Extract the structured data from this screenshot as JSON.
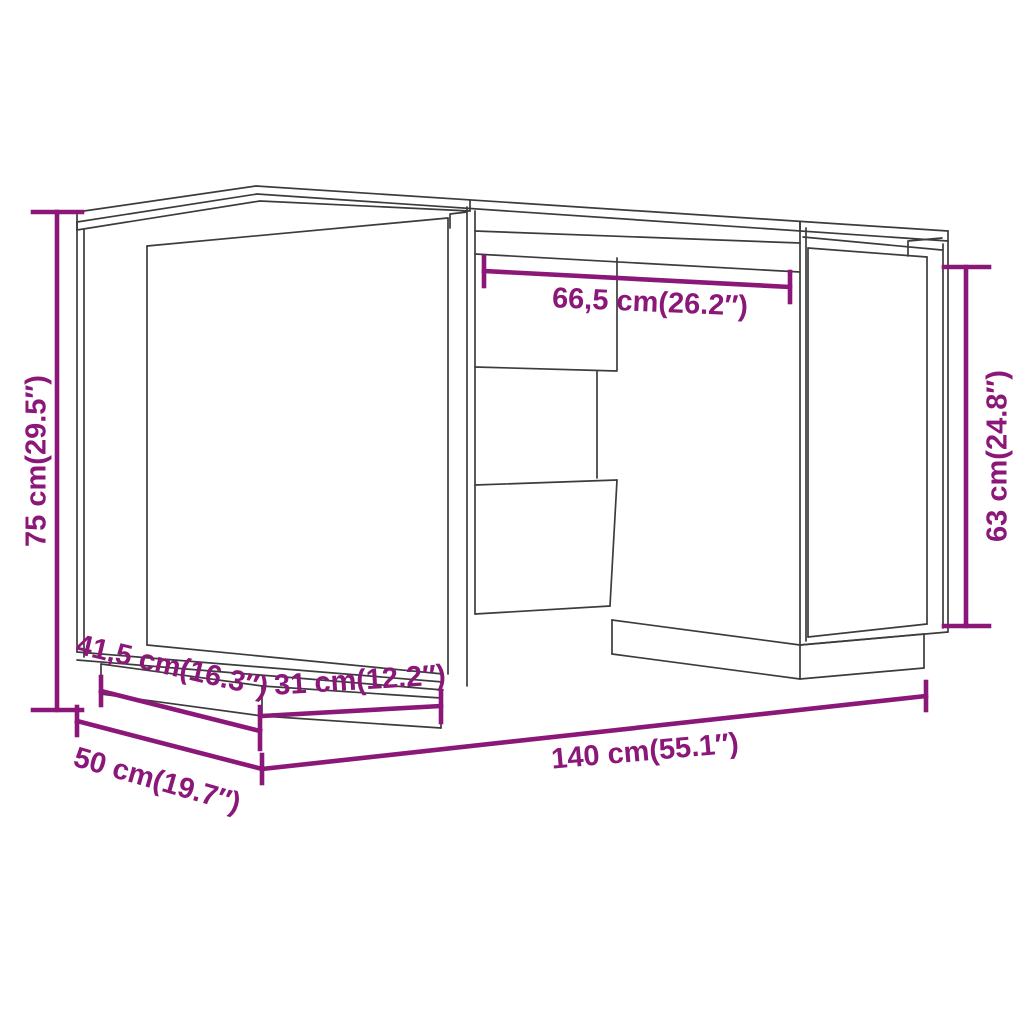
{
  "diagram": {
    "type": "product-dimension-diagram",
    "product": "desk with two side cabinets and open knee space",
    "accent_color": "#8B1778",
    "line_color": "#3c3c3c",
    "background_color": "#ffffff",
    "dimensions": {
      "overall_height": "75 cm(29.5″)",
      "knee_space_width": "66,5 cm(26.2″)",
      "cabinet_side_height": "63 cm(24.8″)",
      "plinth_depth": "41,5 cm(16.3″)",
      "plinth_width": "31 cm(12.2″)",
      "overall_depth": "50 cm(19.7″)",
      "overall_width": "140 cm(55.1″)"
    }
  }
}
